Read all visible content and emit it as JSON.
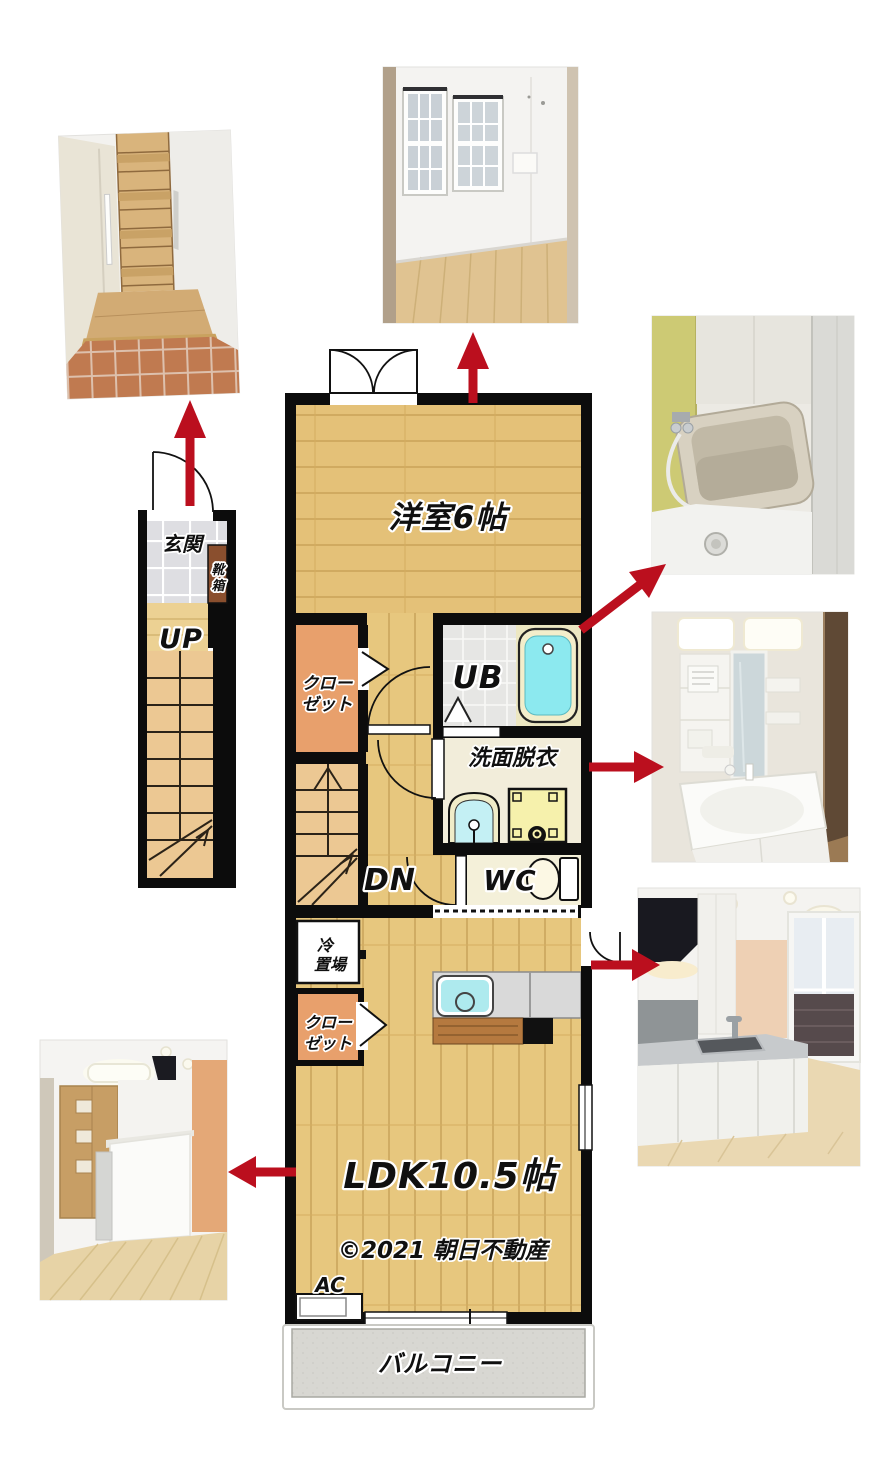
{
  "floor_plan": {
    "labels": {
      "entrance": "玄関",
      "shoe_box": [
        "靴",
        "箱"
      ],
      "stairs_up": "UP",
      "western_room": "洋室6帖",
      "closet_upper": [
        "クロー",
        "ゼット"
      ],
      "unit_bath": "UB",
      "washroom": "洗面脱衣",
      "stairs_down": "DN",
      "toilet": "WC",
      "fridge_space": [
        "冷",
        "置場"
      ],
      "closet_lower": [
        "クロー",
        "ゼット"
      ],
      "ldk": "LDK10.5帖",
      "air_conditioner": "AC",
      "balcony": "バルコニー",
      "copyright": "©2021 朝日不動産"
    },
    "colors": {
      "wall": "#0c0c0c",
      "wood_floor": "#e4c178",
      "ldk_floor": "#e7c77e",
      "stairs": "#ecc893",
      "closet": "#e8a06c",
      "entrance_tile": "#dedee2",
      "shoe_box": "#8a4f2e",
      "ub_tile": "#e6e6e4",
      "bath_water": "#8ce9ef",
      "bath_rim": "#f3eecb",
      "washroom_floor": "#f2edda",
      "washer_yellow": "#f6f1ac",
      "wc_floor": "#f4f0d9",
      "balcony_floor": "#d8d7d2",
      "counter_gray": "#d9d9d9",
      "sink_cyan": "#aeeaee",
      "counter_wood": "#b5793f",
      "arrow_red": "#bb0f1e"
    }
  },
  "photos": {
    "entrance": "entrance-stairs-photo",
    "western_room": "western-room-photo",
    "bathroom": "unit-bath-photo",
    "washroom": "washbasin-photo",
    "kitchen": "kitchen-photo",
    "ldk": "ldk-photo"
  }
}
